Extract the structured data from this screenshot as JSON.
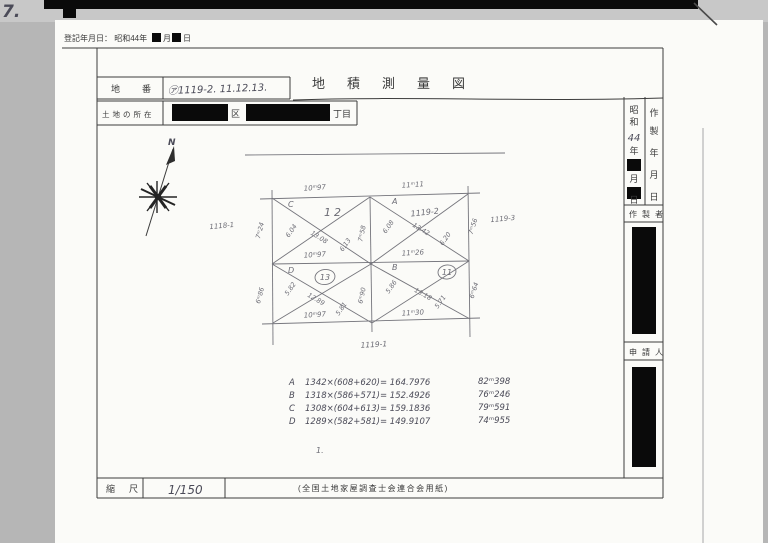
{
  "scan": {
    "corner_mark": "7.",
    "registration_note": "登記年月日： 昭和44年",
    "registration_month_suffix": "月",
    "registration_day_suffix": "日"
  },
  "header": {
    "lot_label": "地番",
    "lot_value": "㋐1119-2. 11.12.13.",
    "title": "地積測量図",
    "location_label": "土地の所在",
    "location_ku_suffix": "区",
    "location_chome_suffix": "丁目"
  },
  "sidebar": {
    "date_era_char1": "昭",
    "date_era_char2": "和",
    "date_year_value": "44",
    "date_year_suffix": "年",
    "date_month_suffix": "月",
    "date_day_suffix": "日",
    "made_label_chars": [
      "作",
      "製",
      "年",
      "月",
      "日"
    ],
    "maker_label": "作製者",
    "applicant_label": "申請人"
  },
  "map": {
    "north_label": "N",
    "parcel_c": {
      "letter": "C",
      "number": "12",
      "top_edge": "10ᵐ97",
      "bottom_edge": "10ᵐ97",
      "left_side": "7ᵐ24",
      "center_side": "7ᵐ58",
      "diagonal": "13.08",
      "offset_a": "6.04",
      "offset_b": "6.13"
    },
    "parcel_a": {
      "letter": "A",
      "number": "1119-2",
      "top_edge": "11ᵐ11",
      "bottom_edge": "11ᵐ26",
      "right_side": "7ᵐ56",
      "diagonal": "13.42",
      "offset_a": "6.08",
      "offset_b": "6.20"
    },
    "parcel_d": {
      "letter": "D",
      "number": "13",
      "bottom_edge": "10ᵐ97",
      "left_side": "6ᵐ86",
      "center_side": "6ᵐ90",
      "diagonal": "12.89",
      "offset_a": "5.82",
      "offset_b": "5.81"
    },
    "parcel_b": {
      "letter": "B",
      "number": "11",
      "bottom_edge": "11ᵐ30",
      "right_side": "6ᵐ64",
      "diagonal": "13.18",
      "offset_a": "5.86",
      "offset_b": "5.71"
    },
    "neighbor_left": "1118-1",
    "neighbor_right": "1119-3",
    "neighbor_bottom": "1119-1",
    "stray_mark": "1."
  },
  "calc": {
    "rows": [
      {
        "letter": "A",
        "formula": "1342×(608+620)= 164.7976",
        "area": "82ᵐ398"
      },
      {
        "letter": "B",
        "formula": "1318×(586+571)= 152.4926",
        "area": "76ᵐ246"
      },
      {
        "letter": "C",
        "formula": "1308×(604+613)= 159.1836",
        "area": "79ᵐ591"
      },
      {
        "letter": "D",
        "formula": "1289×(582+581)= 149.9107",
        "area": "74ᵐ955"
      }
    ]
  },
  "footer": {
    "scale_label": "縮尺",
    "scale_value": "1/150",
    "paper_note": "(全国土地家屋調査士会連合会用紙)"
  }
}
